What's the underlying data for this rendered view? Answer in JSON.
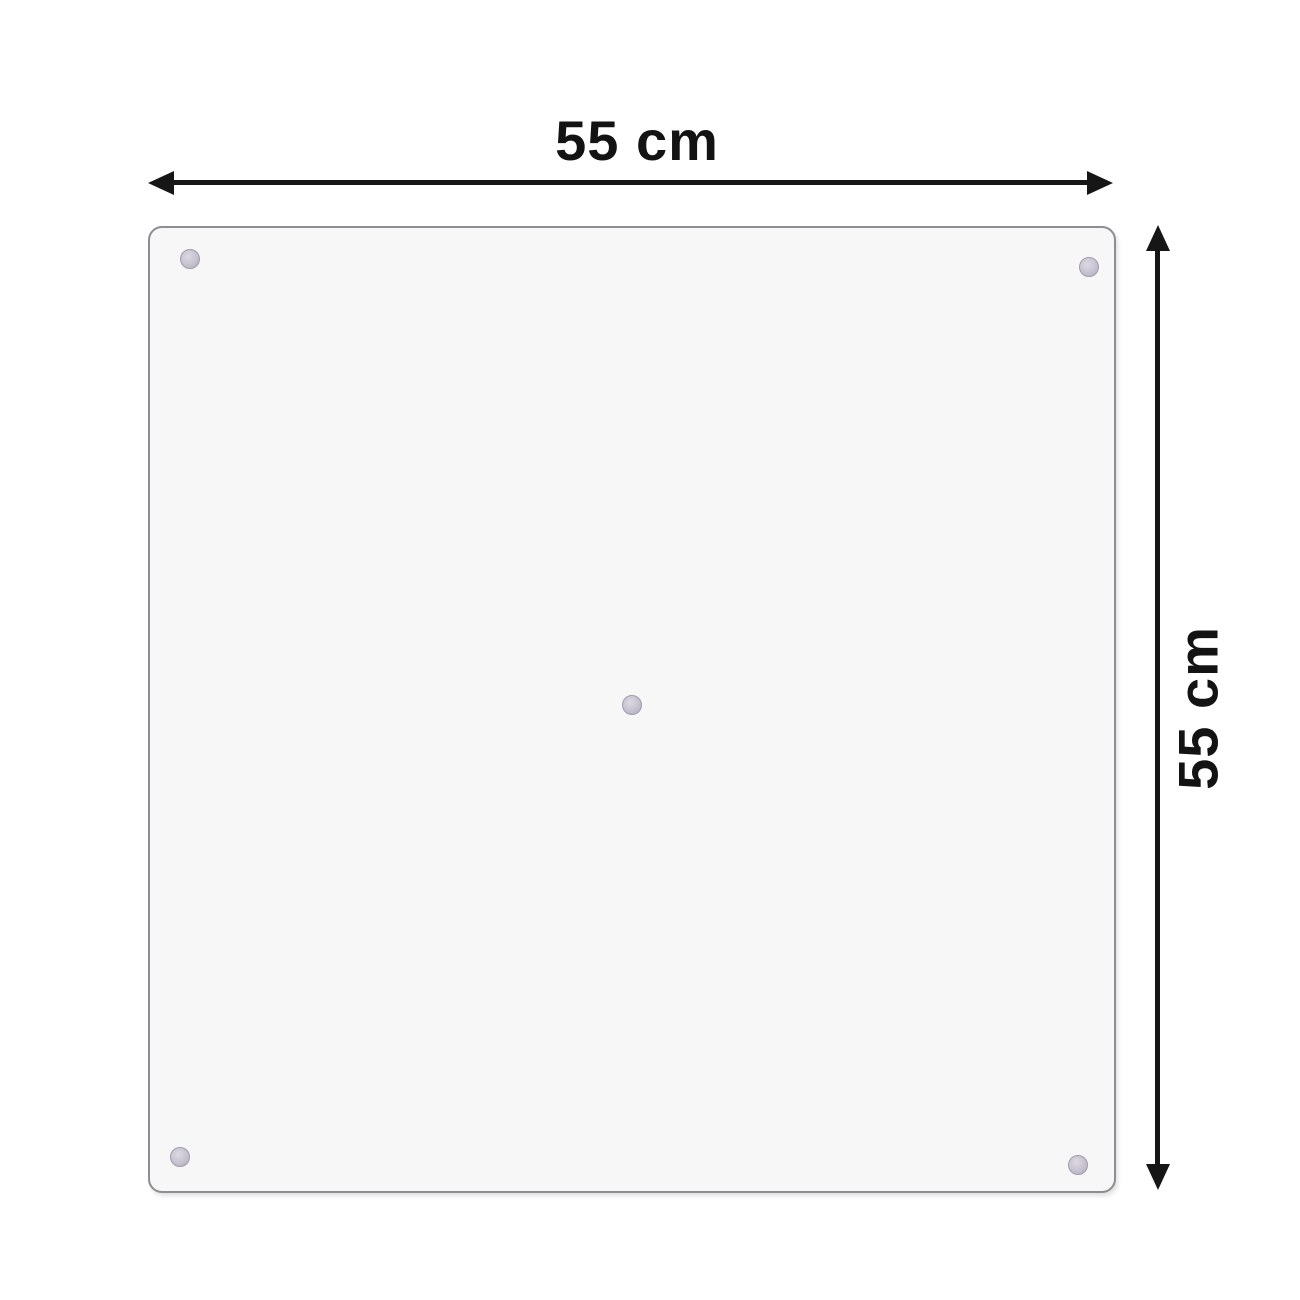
{
  "diagram": {
    "type": "product-dimension-diagram",
    "width_label": "55 cm",
    "height_label": "55 cm",
    "arrow_color": "#161616",
    "panel": {
      "shape": "square-glass-panel",
      "fill_color": "#f7f7f8",
      "border_color": "#8d8d92",
      "suction_cup_color": "#c7c3d0",
      "suction_cups": [
        {
          "position": "top-left"
        },
        {
          "position": "top-right"
        },
        {
          "position": "center"
        },
        {
          "position": "bottom-left"
        },
        {
          "position": "bottom-right"
        }
      ]
    }
  }
}
